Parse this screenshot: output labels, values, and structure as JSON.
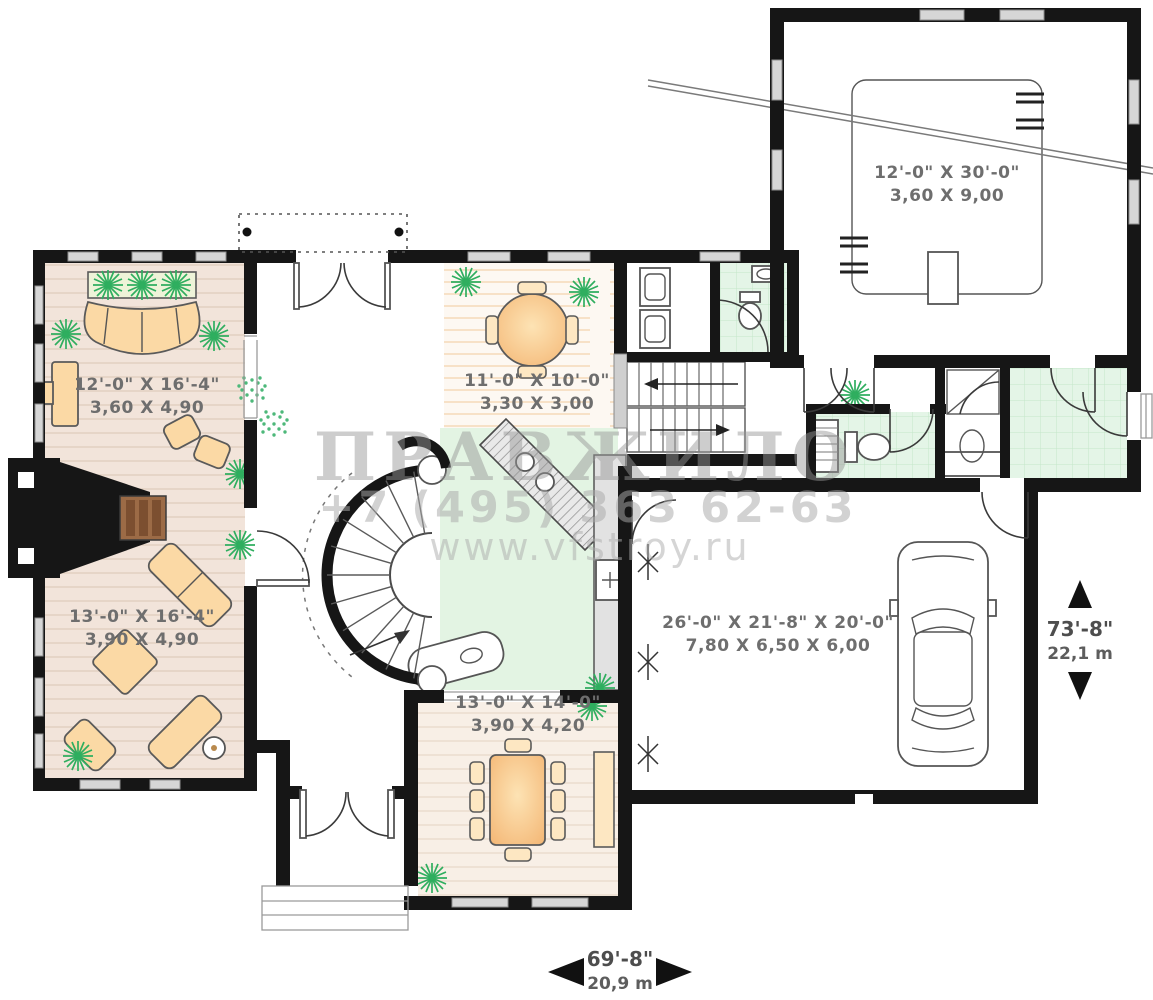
{
  "watermark": {
    "brand": "ПРАВЖИЛО",
    "phone": "+7 (495) 363 62-63",
    "site": "www.vfstroy.ru"
  },
  "rooms": [
    {
      "name": "living-room-upper",
      "imperial": "12'-0\" X 16'-4\"",
      "metric": "3,60 X 4,90"
    },
    {
      "name": "breakfast-nook",
      "imperial": "11'-0\" X 10'-0\"",
      "metric": "3,30 X 3,00"
    },
    {
      "name": "living-room-lower",
      "imperial": "13'-0\" X 16'-4\"",
      "metric": "3,90 X 4,90"
    },
    {
      "name": "dining-room",
      "imperial": "13'-0\" X 14'-0\"",
      "metric": "3,90 X 4,20"
    },
    {
      "name": "garage",
      "imperial": "26'-0\" X 21'-8\" X 20'-0\"",
      "metric": "7,80 X 6,50 X 6,00"
    },
    {
      "name": "bonus-room",
      "imperial": "12'-0\" X 30'-0\"",
      "metric": "3,60 X 9,00"
    }
  ],
  "overall": {
    "width": {
      "imperial": "69'-8\"",
      "metric": "20,9 m"
    },
    "height": {
      "imperial": "73'-8\"",
      "metric": "22,1 m"
    }
  },
  "colors": {
    "wall": "#161616",
    "floor_wood": "#f2e4da",
    "floor_wood_light": "#f8efe6",
    "floor_green": "#e4f5e7",
    "furniture": "#fbd9a5",
    "plant": "#2fae5f",
    "watermark": "#9e9e9e"
  }
}
